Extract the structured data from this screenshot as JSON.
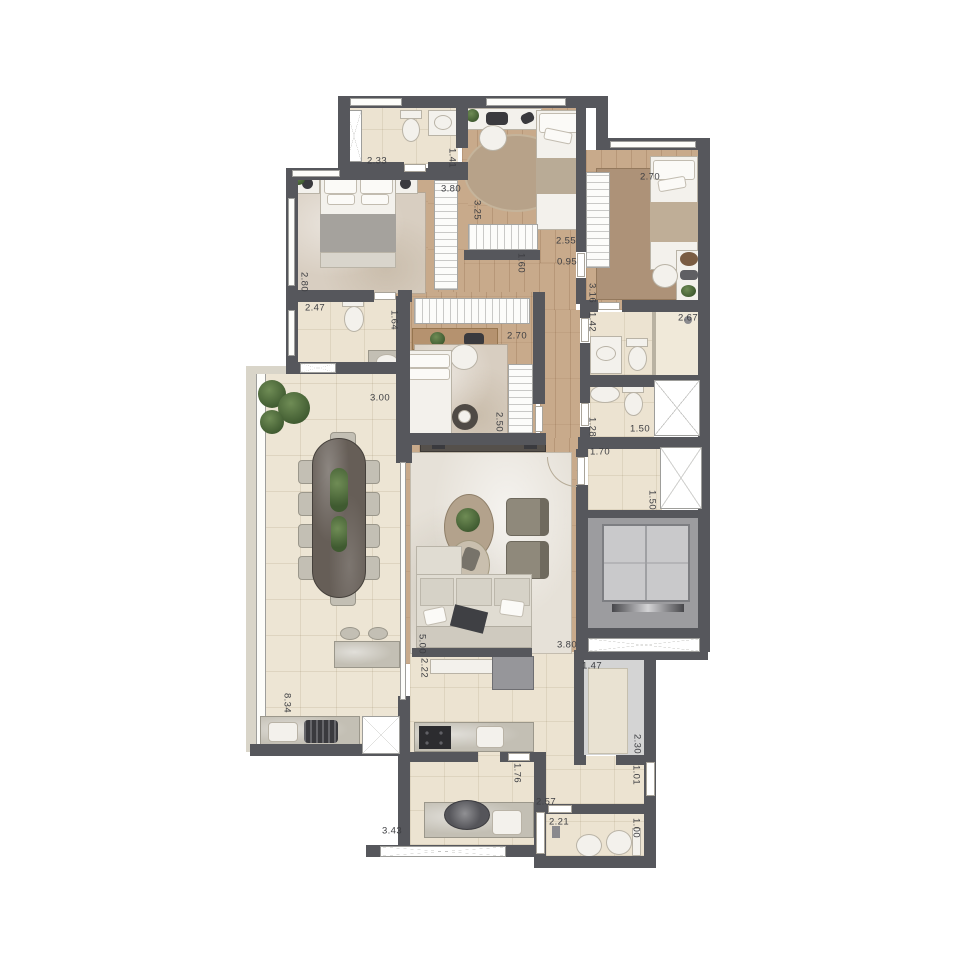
{
  "title": "apartment-floor-plan",
  "colors": {
    "wall": "#56575c",
    "wood": "#c8aa8b",
    "tile": "#ece3d1",
    "terrace": "#ede5d4",
    "rug_master": "#d8cec1",
    "rug_living": "#e6e1d8",
    "rug_brown": "#ad9278",
    "rug_round": "#b7a289",
    "elevator": "#9c9c9f",
    "elevator_cab": "#c9c9cb",
    "counter": "#c3bfb4",
    "dining_table": "#665e57",
    "plant_green": "#4c683a",
    "label_text": "#3d3e42"
  },
  "labels": [
    {
      "t": "2.33",
      "x": 377,
      "y": 161
    },
    {
      "t": "1.41",
      "x": 452,
      "y": 158,
      "v": 1
    },
    {
      "t": "3.80",
      "x": 451,
      "y": 189
    },
    {
      "t": "3.25",
      "x": 477,
      "y": 210,
      "v": 1
    },
    {
      "t": "2.70",
      "x": 650,
      "y": 177
    },
    {
      "t": "2.55",
      "x": 566,
      "y": 241
    },
    {
      "t": "0.95",
      "x": 567,
      "y": 262
    },
    {
      "t": "1.60",
      "x": 521,
      "y": 263,
      "v": 1
    },
    {
      "t": "3.16",
      "x": 592,
      "y": 293,
      "v": 1
    },
    {
      "t": "1.42",
      "x": 592,
      "y": 322,
      "v": 1
    },
    {
      "t": "2.67",
      "x": 688,
      "y": 318
    },
    {
      "t": "2.80",
      "x": 304,
      "y": 282,
      "v": 1
    },
    {
      "t": "2.47",
      "x": 315,
      "y": 308
    },
    {
      "t": "1.64",
      "x": 394,
      "y": 320,
      "v": 1
    },
    {
      "t": "2.70",
      "x": 517,
      "y": 336
    },
    {
      "t": "2.50",
      "x": 499,
      "y": 422,
      "v": 1
    },
    {
      "t": "1.28",
      "x": 592,
      "y": 427,
      "v": 1
    },
    {
      "t": "1.50",
      "x": 640,
      "y": 429
    },
    {
      "t": "1.70",
      "x": 600,
      "y": 452
    },
    {
      "t": "1.50",
      "x": 652,
      "y": 500,
      "v": 1
    },
    {
      "t": "3.00",
      "x": 380,
      "y": 398
    },
    {
      "t": "8.34",
      "x": 287,
      "y": 703,
      "v": 1
    },
    {
      "t": "5.00",
      "x": 422,
      "y": 644,
      "v": 1
    },
    {
      "t": "2.22",
      "x": 424,
      "y": 668,
      "v": 1
    },
    {
      "t": "3.80",
      "x": 567,
      "y": 645
    },
    {
      "t": "1.47",
      "x": 592,
      "y": 666
    },
    {
      "t": "2.30",
      "x": 637,
      "y": 744,
      "v": 1
    },
    {
      "t": "1.01",
      "x": 636,
      "y": 775,
      "v": 1
    },
    {
      "t": "1.76",
      "x": 517,
      "y": 773,
      "v": 1
    },
    {
      "t": "2.57",
      "x": 546,
      "y": 802
    },
    {
      "t": "3.43",
      "x": 392,
      "y": 831
    },
    {
      "t": "2.21",
      "x": 559,
      "y": 822
    },
    {
      "t": "1.00",
      "x": 636,
      "y": 828,
      "v": 1
    }
  ]
}
